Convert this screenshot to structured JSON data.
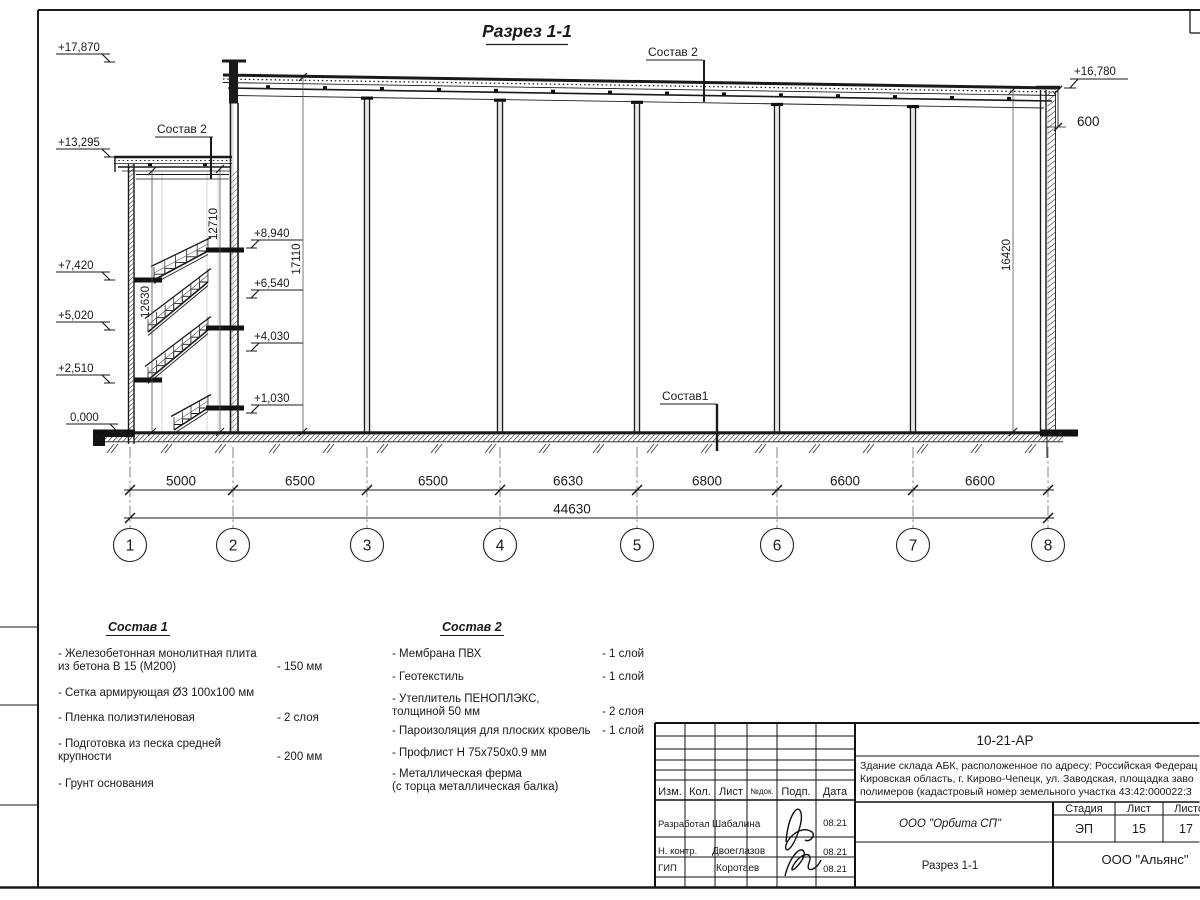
{
  "sheet": {
    "section_label": "Разрез 1-1",
    "roof_label": "Состав 2",
    "canopy_label": "Состав 2",
    "floor_label": "Состав1",
    "elev_left": [
      "+17,870",
      "+13,295",
      "+7,420",
      "+5,020",
      "+2,510",
      "0,000"
    ],
    "elev_inner": [
      "+8,940",
      "+6,540",
      "+4,030",
      "+1,030"
    ],
    "elev_right": "+16,780",
    "dim_600": "600",
    "vdims": {
      "left_inner": "12630",
      "left_outer": "12710",
      "mid": "17110",
      "right": "16420"
    },
    "dims": [
      "5000",
      "6500",
      "6500",
      "6630",
      "6800",
      "6600",
      "6600"
    ],
    "dim_total": "44630",
    "grids": [
      "1",
      "2",
      "3",
      "4",
      "5",
      "6",
      "7",
      "8"
    ]
  },
  "legend1": {
    "title": "Состав 1",
    "items": [
      {
        "text": "- Железобетонная  монолитная плита\nиз бетона В 15 (М200)",
        "value": "- 150 мм"
      },
      {
        "text": "- Сетка армирующая Ø3 100х100 мм",
        "value": ""
      },
      {
        "text": "- Пленка полиэтиленовая",
        "value": "-  2 слоя"
      },
      {
        "text": "- Подготовка из песка средней\nкрупности",
        "value": "- 200 мм"
      },
      {
        "text": "- Грунт основания",
        "value": ""
      }
    ]
  },
  "legend2": {
    "title": "Состав 2",
    "items": [
      {
        "text": "- Мембрана ПВХ",
        "value": "- 1 слой"
      },
      {
        "text": "- Геотекстиль",
        "value": "- 1 слой"
      },
      {
        "text": "- Утеплитель ПЕНОПЛЭКС,\nтолщиной 50 мм",
        "value": "- 2 слоя"
      },
      {
        "text": "- Пароизоляция для плоских кровель",
        "value": "- 1 слой"
      },
      {
        "text": "- Профлист Н 75х750х0.9 мм",
        "value": ""
      },
      {
        "text": "- Металлическая ферма\n(с торца металлическая балка)",
        "value": ""
      }
    ]
  },
  "titleblock": {
    "doc_number": "10-21-АР",
    "address_lines": [
      "Здание склада АБК, расположенное по адресу: Российская Федерац",
      "Кировская область, г. Кирово-Чепецк, ул. Заводская, площадка заво",
      "полимеров (кадастровый номер земельного участка 43:42:000022:3"
    ],
    "col_headers": {
      "izm": "Изм.",
      "kol": "Кол.",
      "list": "Лист",
      "ndok": "№док.",
      "podp": "Подп.",
      "data": "Дата"
    },
    "rows": [
      {
        "role": "Разработал",
        "name": "Шабалина",
        "date": "08.21"
      },
      {
        "role": "Н. контр.",
        "name": "Двоеглазов",
        "date": "08.21"
      },
      {
        "role": "ГИП",
        "name": "Коротаев",
        "date": "08.21"
      }
    ],
    "org": "ООО \"Орбита СП\"",
    "section_name": "Разрез 1-1",
    "stage_label": "Стадия",
    "sheet_label": "Лист",
    "sheets_label": "Листов",
    "stage": "ЭП",
    "sheet_num": "15",
    "sheets_total": "17",
    "company": "ООО \"Альянс\""
  }
}
